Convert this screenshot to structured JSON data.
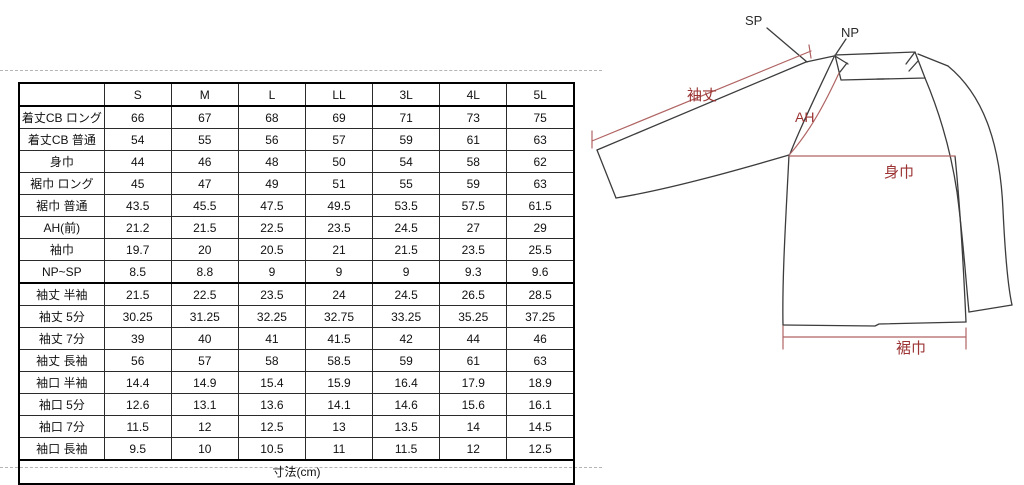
{
  "table": {
    "size_headers": [
      "S",
      "M",
      "L",
      "LL",
      "3L",
      "4L",
      "5L"
    ],
    "rows": [
      {
        "label": "着丈CB ロング",
        "values": [
          "66",
          "67",
          "68",
          "69",
          "71",
          "73",
          "75"
        ]
      },
      {
        "label": "着丈CB 普通",
        "values": [
          "54",
          "55",
          "56",
          "57",
          "59",
          "61",
          "63"
        ]
      },
      {
        "label": "身巾",
        "values": [
          "44",
          "46",
          "48",
          "50",
          "54",
          "58",
          "62"
        ]
      },
      {
        "label": "裾巾 ロング",
        "values": [
          "45",
          "47",
          "49",
          "51",
          "55",
          "59",
          "63"
        ]
      },
      {
        "label": "裾巾 普通",
        "values": [
          "43.5",
          "45.5",
          "47.5",
          "49.5",
          "53.5",
          "57.5",
          "61.5"
        ]
      },
      {
        "label": "AH(前)",
        "values": [
          "21.2",
          "21.5",
          "22.5",
          "23.5",
          "24.5",
          "27",
          "29"
        ]
      },
      {
        "label": "袖巾",
        "values": [
          "19.7",
          "20",
          "20.5",
          "21",
          "21.5",
          "23.5",
          "25.5"
        ]
      },
      {
        "label": "NP~SP",
        "values": [
          "8.5",
          "8.8",
          "9",
          "9",
          "9",
          "9.3",
          "9.6"
        ]
      },
      {
        "label": "袖丈 半袖",
        "values": [
          "21.5",
          "22.5",
          "23.5",
          "24",
          "24.5",
          "26.5",
          "28.5"
        ]
      },
      {
        "label": "袖丈 5分",
        "values": [
          "30.25",
          "31.25",
          "32.25",
          "32.75",
          "33.25",
          "35.25",
          "37.25"
        ]
      },
      {
        "label": "袖丈 7分",
        "values": [
          "39",
          "40",
          "41",
          "41.5",
          "42",
          "44",
          "46"
        ]
      },
      {
        "label": "袖丈 長袖",
        "values": [
          "56",
          "57",
          "58",
          "58.5",
          "59",
          "61",
          "63"
        ]
      },
      {
        "label": "袖口 半袖",
        "values": [
          "14.4",
          "14.9",
          "15.4",
          "15.9",
          "16.4",
          "17.9",
          "18.9"
        ]
      },
      {
        "label": "袖口 5分",
        "values": [
          "12.6",
          "13.1",
          "13.6",
          "14.1",
          "14.6",
          "15.6",
          "16.1"
        ]
      },
      {
        "label": "袖口 7分",
        "values": [
          "11.5",
          "12",
          "12.5",
          "13",
          "13.5",
          "14",
          "14.5"
        ]
      },
      {
        "label": "袖口 長袖",
        "values": [
          "9.5",
          "10",
          "10.5",
          "11",
          "11.5",
          "12",
          "12.5"
        ]
      }
    ],
    "group_separator_after_rows": [
      8,
      16
    ],
    "footer": "寸法(cm)"
  },
  "diagram": {
    "labels": {
      "shoulder_point": "SP",
      "neck_point": "NP",
      "sleeve_length": "袖丈",
      "armhole": "AH",
      "body_width": "身巾",
      "hem_width": "裾巾"
    },
    "colors": {
      "outline": "#3c3c3c",
      "dimension_line": "#b06363",
      "dimension_text": "#9c3434"
    }
  }
}
